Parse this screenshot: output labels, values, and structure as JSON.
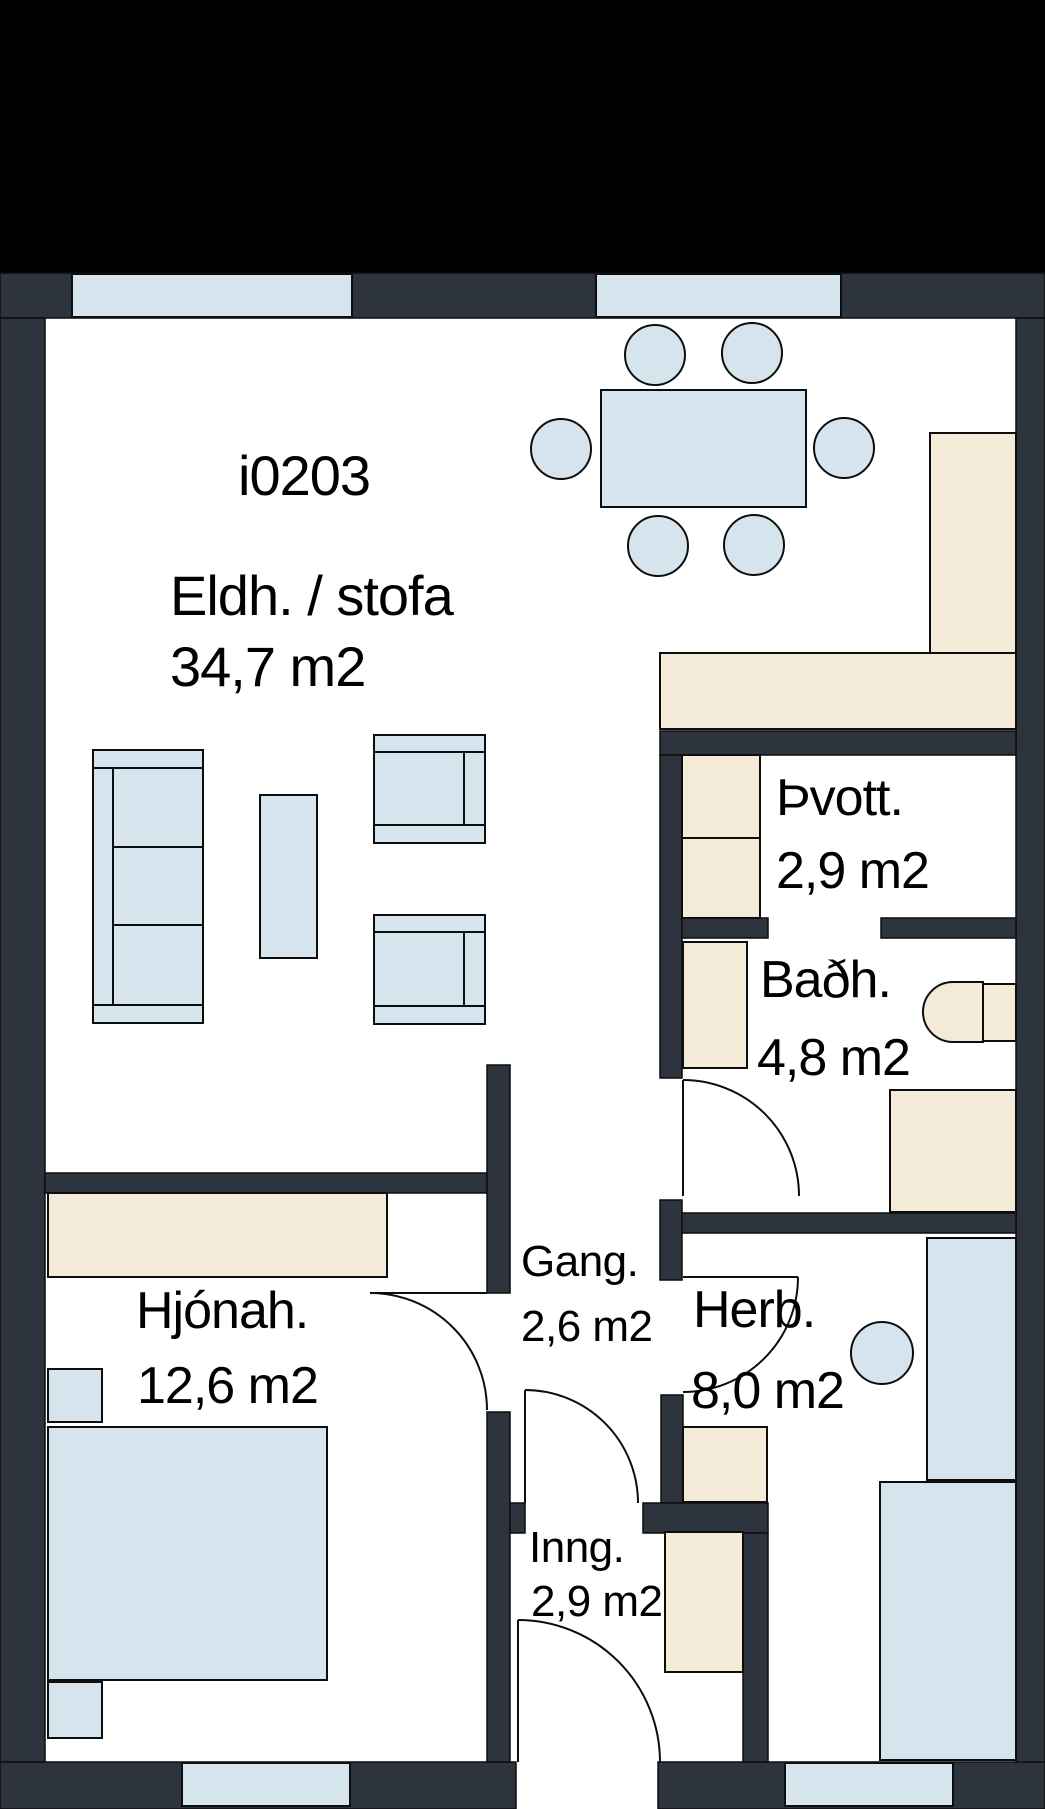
{
  "meta": {
    "unit_id": "i0203",
    "type": "apartment-floor-plan"
  },
  "colors": {
    "header": "#000000",
    "floor": "#ffffff",
    "wall": "#2e343e",
    "outline": "#0d0d0d",
    "window": "#d6e5ed",
    "soft": "#d6e5ed",
    "wood": "#f4ead8"
  },
  "rooms": [
    {
      "id": "kitchen-living",
      "label": "Eldh. / stofa",
      "area": "34,7 m2"
    },
    {
      "id": "laundry",
      "label": "Þvott.",
      "area": "2,9 m2"
    },
    {
      "id": "bathroom",
      "label": "Baðh.",
      "area": "4,8 m2"
    },
    {
      "id": "master-bedroom",
      "label": "Hjónah.",
      "area": "12,6 m2"
    },
    {
      "id": "hallway",
      "label": "Gang.",
      "area": "2,6 m2"
    },
    {
      "id": "bedroom",
      "label": "Herb.",
      "area": "8,0 m2"
    },
    {
      "id": "entrance",
      "label": "Inng.",
      "area": "2,9 m2"
    }
  ],
  "labels": [
    {
      "name": "unit-id-label",
      "text": "i0203",
      "x": 238,
      "y": 448,
      "size": "L"
    },
    {
      "name": "room-kitchen-living-label",
      "text": "Eldh. / stofa",
      "x": 170,
      "y": 568,
      "size": "L"
    },
    {
      "name": "area-kitchen-living-label",
      "text": "34,7 m2",
      "x": 170,
      "y": 639,
      "size": "L"
    },
    {
      "name": "room-laundry-label",
      "text": "Þvott.",
      "x": 776,
      "y": 772,
      "size": "M"
    },
    {
      "name": "area-laundry-label",
      "text": "2,9 m2",
      "x": 776,
      "y": 845,
      "size": "M"
    },
    {
      "name": "room-bathroom-label",
      "text": "Baðh.",
      "x": 760,
      "y": 954,
      "size": "M"
    },
    {
      "name": "area-bathroom-label",
      "text": "4,8 m2",
      "x": 757,
      "y": 1032,
      "size": "M"
    },
    {
      "name": "room-master-bedroom-label",
      "text": "Hjónah.",
      "x": 136,
      "y": 1285,
      "size": "M"
    },
    {
      "name": "area-master-bedroom-label",
      "text": "12,6 m2",
      "x": 137,
      "y": 1360,
      "size": "M"
    },
    {
      "name": "room-hallway-label",
      "text": "Gang.",
      "x": 521,
      "y": 1240,
      "size": "S"
    },
    {
      "name": "area-hallway-label",
      "text": "2,6 m2",
      "x": 521,
      "y": 1305,
      "size": "S"
    },
    {
      "name": "room-bedroom-label",
      "text": "Herb.",
      "x": 693,
      "y": 1284,
      "size": "M"
    },
    {
      "name": "area-bedroom-label",
      "text": "8,0 m2",
      "x": 691,
      "y": 1365,
      "size": "M"
    },
    {
      "name": "room-entrance-label",
      "text": "Inng.",
      "x": 529,
      "y": 1526,
      "size": "S"
    },
    {
      "name": "area-entrance-label",
      "text": "2,9 m2",
      "x": 531,
      "y": 1580,
      "size": "S"
    }
  ],
  "geometry": {
    "canvas": {
      "w": 1045,
      "h": 1809
    },
    "header": {
      "x": 0,
      "y": 0,
      "w": 1045,
      "h": 273
    },
    "floor": {
      "x": 0,
      "y": 273,
      "w": 1045,
      "h": 1536
    },
    "walls": [
      {
        "name": "wall-exterior-top",
        "x": 0,
        "y": 273,
        "w": 1045,
        "h": 45
      },
      {
        "name": "wall-exterior-left",
        "x": 0,
        "y": 318,
        "w": 45,
        "h": 1444
      },
      {
        "name": "wall-exterior-right",
        "x": 1016,
        "y": 318,
        "w": 29,
        "h": 1491
      },
      {
        "name": "wall-exterior-bottom-left",
        "x": 0,
        "y": 1762,
        "w": 516,
        "h": 47
      },
      {
        "name": "wall-exterior-bottom-right",
        "x": 658,
        "y": 1762,
        "w": 387,
        "h": 47
      },
      {
        "name": "wall-bedroom-living",
        "x": 45,
        "y": 1173,
        "w": 442,
        "h": 20
      },
      {
        "name": "wall-living-hallway",
        "x": 487,
        "y": 1065,
        "w": 23,
        "h": 228
      },
      {
        "name": "wall-entrance-west",
        "x": 487,
        "y": 1412,
        "w": 23,
        "h": 350
      },
      {
        "name": "wall-kitchen-laundry",
        "x": 660,
        "y": 731,
        "w": 356,
        "h": 24
      },
      {
        "name": "wall-laundry-west",
        "x": 660,
        "y": 755,
        "w": 22,
        "h": 323
      },
      {
        "name": "wall-laundry-bath-left",
        "x": 682,
        "y": 918,
        "w": 86,
        "h": 20
      },
      {
        "name": "wall-laundry-bath-right",
        "x": 881,
        "y": 918,
        "w": 135,
        "h": 20
      },
      {
        "name": "wall-bath-west-stub",
        "x": 660,
        "y": 1200,
        "w": 22,
        "h": 80
      },
      {
        "name": "wall-bath-bedroom",
        "x": 682,
        "y": 1213,
        "w": 334,
        "h": 20
      },
      {
        "name": "wall-bedroom-west",
        "x": 661,
        "y": 1395,
        "w": 22,
        "h": 108
      },
      {
        "name": "wall-hall-entrance-stub",
        "x": 510,
        "y": 1503,
        "w": 15,
        "h": 30
      },
      {
        "name": "wall-hall-entrance-right",
        "x": 643,
        "y": 1503,
        "w": 125,
        "h": 30
      },
      {
        "name": "wall-bedroom-entrance",
        "x": 743,
        "y": 1533,
        "w": 25,
        "h": 229
      }
    ],
    "windows": [
      {
        "name": "window-living-1",
        "x": 72,
        "y": 274,
        "w": 280,
        "h": 43
      },
      {
        "name": "window-living-2",
        "x": 596,
        "y": 274,
        "w": 245,
        "h": 43
      },
      {
        "name": "window-master-bed",
        "x": 182,
        "y": 1763,
        "w": 168,
        "h": 43
      },
      {
        "name": "window-bedroom",
        "x": 785,
        "y": 1763,
        "w": 168,
        "h": 43
      }
    ],
    "furniture": [
      {
        "name": "dining-table",
        "kind": "rect",
        "fill": "soft",
        "x": 601,
        "y": 390,
        "w": 205,
        "h": 117
      },
      {
        "name": "dining-chair",
        "kind": "circle",
        "fill": "soft",
        "cx": 655,
        "cy": 355,
        "r": 30
      },
      {
        "name": "dining-chair",
        "kind": "circle",
        "fill": "soft",
        "cx": 752,
        "cy": 353,
        "r": 30
      },
      {
        "name": "dining-chair",
        "kind": "circle",
        "fill": "soft",
        "cx": 561,
        "cy": 449,
        "r": 30
      },
      {
        "name": "dining-chair",
        "kind": "circle",
        "fill": "soft",
        "cx": 844,
        "cy": 448,
        "r": 30
      },
      {
        "name": "dining-chair",
        "kind": "circle",
        "fill": "soft",
        "cx": 658,
        "cy": 546,
        "r": 30
      },
      {
        "name": "dining-chair",
        "kind": "circle",
        "fill": "soft",
        "cx": 754,
        "cy": 545,
        "r": 30
      },
      {
        "name": "kitchen-counter-side",
        "kind": "rect",
        "fill": "wood",
        "x": 930,
        "y": 433,
        "w": 86,
        "h": 220
      },
      {
        "name": "kitchen-counter",
        "kind": "rect",
        "fill": "wood",
        "x": 660,
        "y": 653,
        "w": 356,
        "h": 76
      },
      {
        "name": "sofa-body",
        "kind": "rect",
        "fill": "soft",
        "x": 93,
        "y": 750,
        "w": 110,
        "h": 273
      },
      {
        "name": "sofa-armrest-top",
        "kind": "rect",
        "fill": "soft",
        "x": 93,
        "y": 750,
        "w": 110,
        "h": 18
      },
      {
        "name": "sofa-armrest-bottom",
        "kind": "rect",
        "fill": "soft",
        "x": 93,
        "y": 1005,
        "w": 110,
        "h": 18
      },
      {
        "name": "sofa-cushion",
        "kind": "rect",
        "fill": "soft",
        "x": 113,
        "y": 768,
        "w": 90,
        "h": 79
      },
      {
        "name": "sofa-cushion",
        "kind": "rect",
        "fill": "soft",
        "x": 113,
        "y": 847,
        "w": 90,
        "h": 78
      },
      {
        "name": "sofa-cushion",
        "kind": "rect",
        "fill": "soft",
        "x": 113,
        "y": 925,
        "w": 90,
        "h": 80
      },
      {
        "name": "coffee-table",
        "kind": "rect",
        "fill": "soft",
        "x": 260,
        "y": 795,
        "w": 57,
        "h": 163
      },
      {
        "name": "armchair-body",
        "kind": "rect",
        "fill": "soft",
        "x": 374,
        "y": 735,
        "w": 111,
        "h": 108
      },
      {
        "name": "armchair-seat",
        "kind": "rect",
        "fill": "soft",
        "x": 374,
        "y": 752,
        "w": 90,
        "h": 73
      },
      {
        "name": "armchair-back",
        "kind": "rect",
        "fill": "soft",
        "x": 464,
        "y": 752,
        "w": 21,
        "h": 73
      },
      {
        "name": "armchair-body",
        "kind": "rect",
        "fill": "soft",
        "x": 374,
        "y": 915,
        "w": 111,
        "h": 109
      },
      {
        "name": "armchair-seat",
        "kind": "rect",
        "fill": "soft",
        "x": 374,
        "y": 932,
        "w": 90,
        "h": 74
      },
      {
        "name": "armchair-back",
        "kind": "rect",
        "fill": "soft",
        "x": 464,
        "y": 932,
        "w": 21,
        "h": 74
      },
      {
        "name": "laundry-cabinet",
        "kind": "rect",
        "fill": "wood",
        "x": 682,
        "y": 755,
        "w": 78,
        "h": 83
      },
      {
        "name": "laundry-cabinet",
        "kind": "rect",
        "fill": "wood",
        "x": 682,
        "y": 838,
        "w": 78,
        "h": 80
      },
      {
        "name": "bath-cabinet",
        "kind": "rect",
        "fill": "wood",
        "x": 683,
        "y": 942,
        "w": 64,
        "h": 126
      },
      {
        "name": "toilet-bowl",
        "kind": "path",
        "fill": "wood",
        "d": "M 983 982 L 953 982 A 30 30 0 0 0 953 1042 L 983 1042 Z"
      },
      {
        "name": "toilet-tank",
        "kind": "rect",
        "fill": "wood",
        "x": 983,
        "y": 984,
        "w": 33,
        "h": 57
      },
      {
        "name": "shower-unit",
        "kind": "rect",
        "fill": "wood",
        "x": 890,
        "y": 1090,
        "w": 126,
        "h": 122
      },
      {
        "name": "bedroom-wardrobe",
        "kind": "rect",
        "fill": "wood",
        "x": 48,
        "y": 1193,
        "w": 339,
        "h": 84
      },
      {
        "name": "nightstand",
        "kind": "rect",
        "fill": "soft",
        "x": 48,
        "y": 1369,
        "w": 54,
        "h": 53
      },
      {
        "name": "master-bed",
        "kind": "rect",
        "fill": "soft",
        "x": 48,
        "y": 1427,
        "w": 279,
        "h": 253
      },
      {
        "name": "nightstand",
        "kind": "rect",
        "fill": "soft",
        "x": 48,
        "y": 1682,
        "w": 54,
        "h": 56
      },
      {
        "name": "bedroom-cabinet",
        "kind": "rect",
        "fill": "wood",
        "x": 683,
        "y": 1427,
        "w": 84,
        "h": 75
      },
      {
        "name": "bedroom-desk",
        "kind": "rect",
        "fill": "soft",
        "x": 927,
        "y": 1238,
        "w": 89,
        "h": 242
      },
      {
        "name": "bedroom-stool",
        "kind": "circle",
        "fill": "soft",
        "cx": 882,
        "cy": 1353,
        "r": 31
      },
      {
        "name": "bedroom-bed",
        "kind": "rect",
        "fill": "soft",
        "x": 880,
        "y": 1482,
        "w": 136,
        "h": 278
      },
      {
        "name": "entrance-cabinet",
        "kind": "rect",
        "fill": "wood",
        "x": 665,
        "y": 1532,
        "w": 78,
        "h": 140
      }
    ],
    "doors": [
      {
        "name": "door-master-bedroom",
        "leaf": "M 370 1293 L 487 1293",
        "arc": "M 370 1293 A 117 117 0 0 1 487 1410"
      },
      {
        "name": "door-bathroom",
        "leaf": "M 683 1080 L 683 1196",
        "arc": "M 683 1080 A 116 116 0 0 1 799 1196"
      },
      {
        "name": "door-bedroom",
        "leaf": "M 683 1277 L 798 1277",
        "arc": "M 798 1277 A 115 115 0 0 1 683 1392"
      },
      {
        "name": "door-hall-entrance",
        "leaf": "M 525 1390 L 525 1503",
        "arc": "M 525 1390 A 113 113 0 0 1 638 1503"
      },
      {
        "name": "door-main-entrance",
        "leaf": "M 518 1620 L 518 1762",
        "arc": "M 518 1620 A 142 142 0 0 1 660 1762"
      }
    ]
  }
}
